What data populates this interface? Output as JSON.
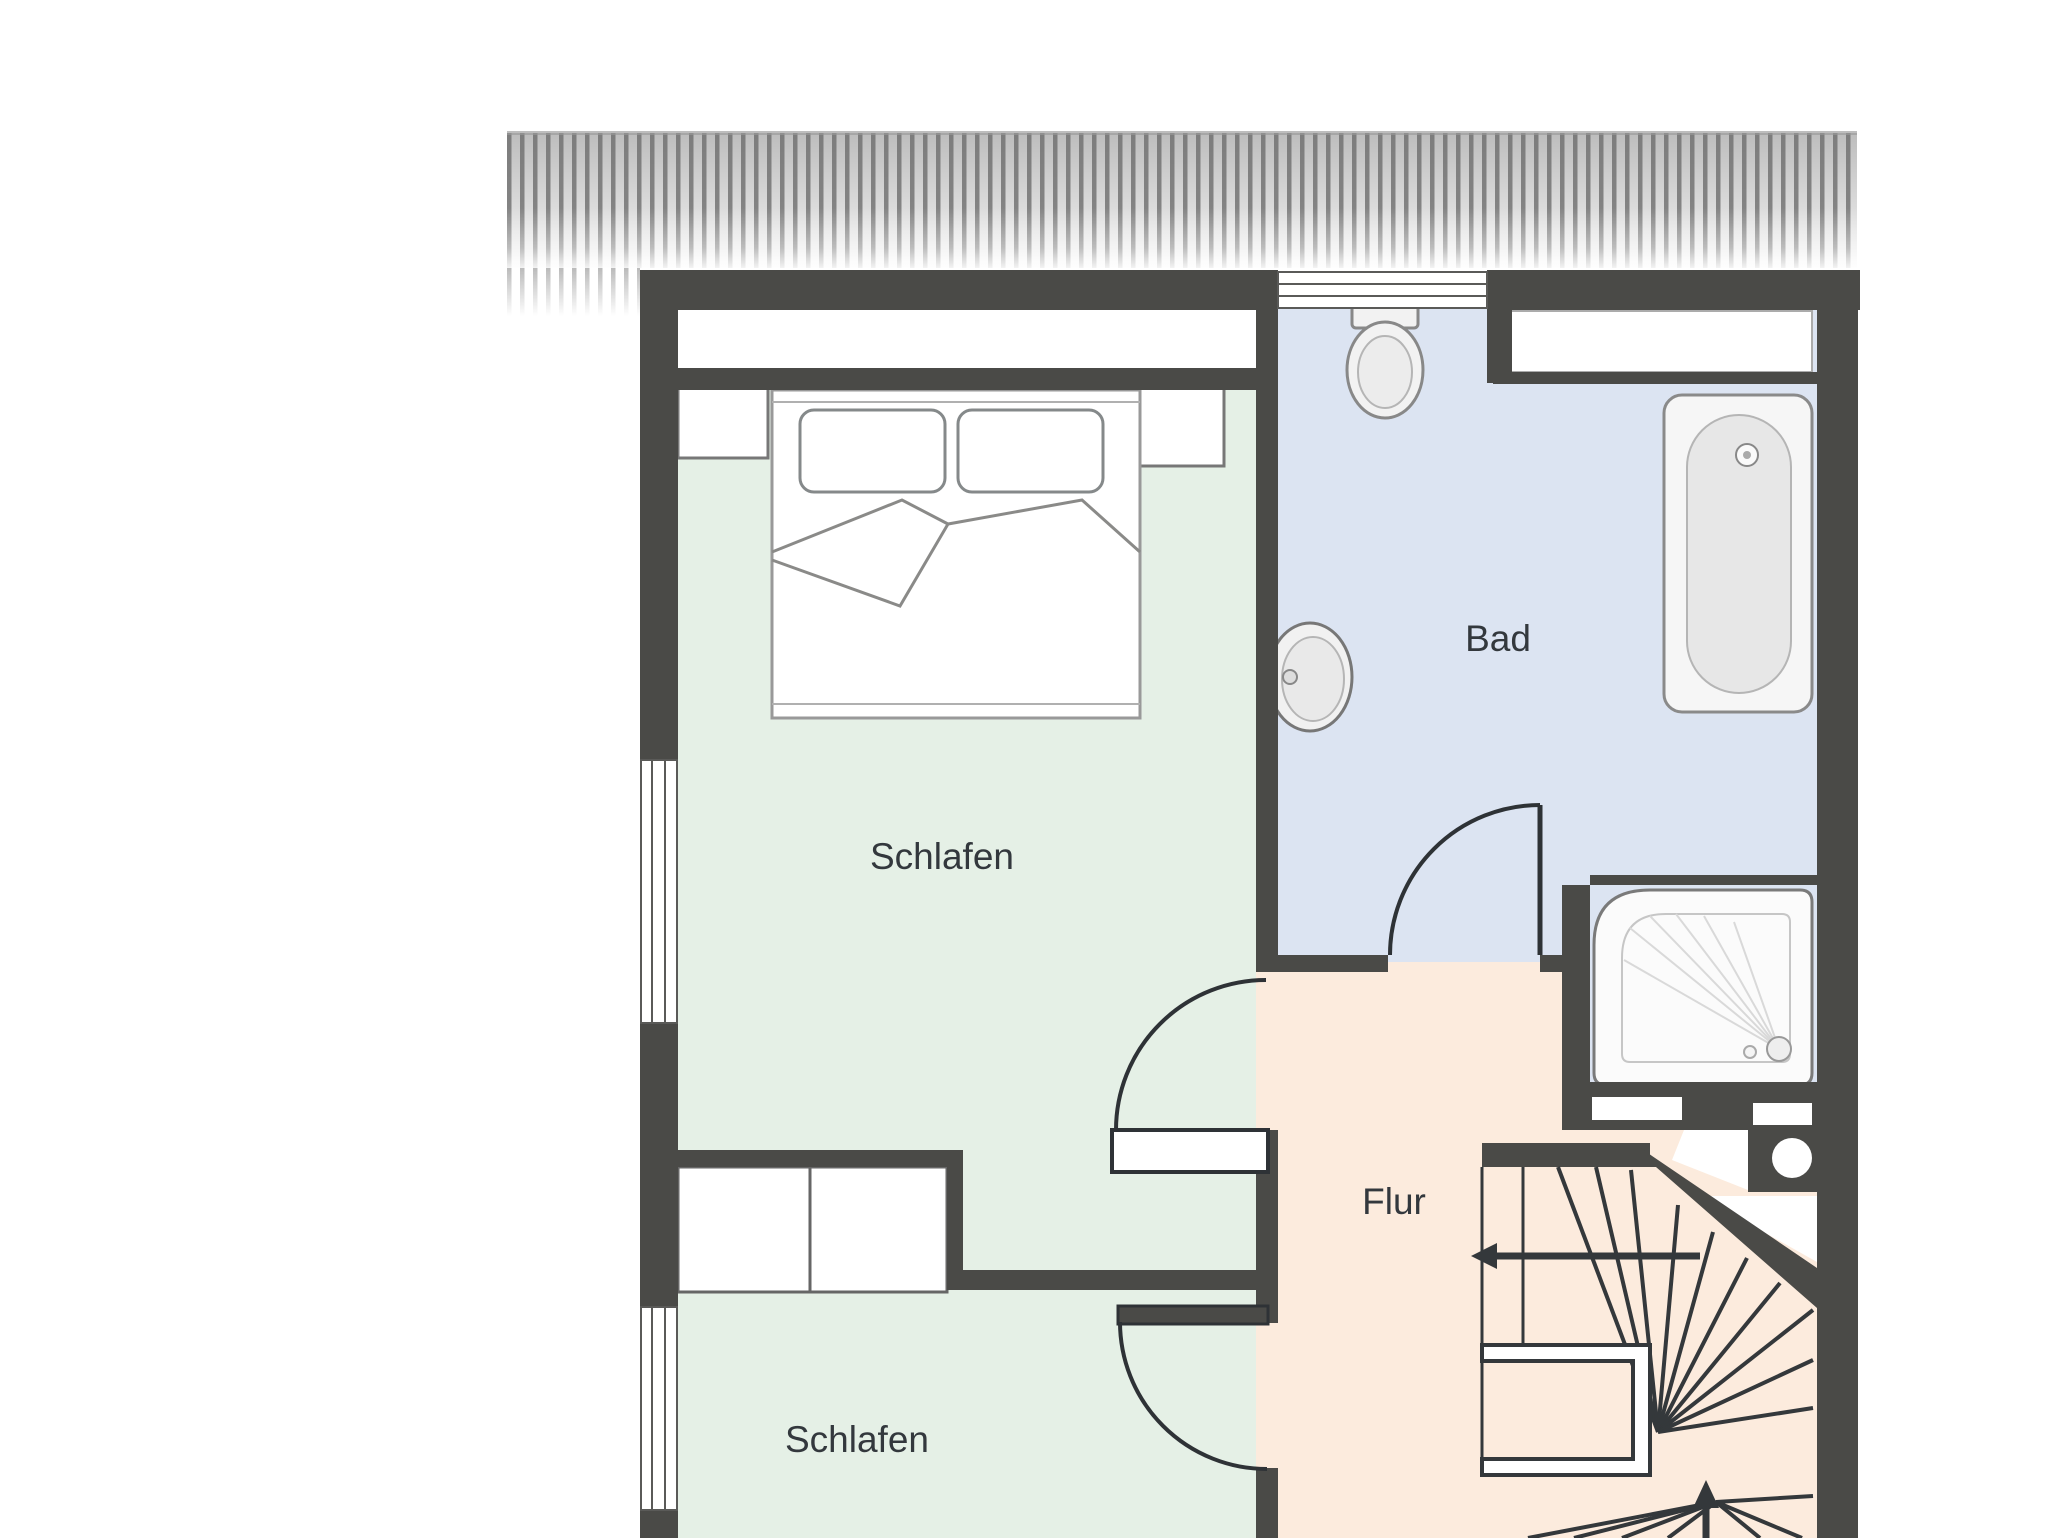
{
  "floorplan": {
    "labels": {
      "bedroom_top": "Schlafen",
      "bathroom": "Bad",
      "hallway": "Flur",
      "bedroom_bottom": "Schlafen"
    },
    "colors": {
      "wall": "#4a4a47",
      "bedroom_fill": "#e5f0e6",
      "bathroom_fill": "#dce4f2",
      "hallway_fill": "#fcebdd",
      "door_line": "#2e3236",
      "stair_line": "#34383b",
      "label_text": "#33383d",
      "fixture_outline": "#8a8a88",
      "hatch_stripe": "#6d6d6d",
      "canvas": "#ffffff"
    },
    "fixtures": {
      "bed": "double-bed",
      "nightstands": 2,
      "wardrobe_sections": 2,
      "toilet": "wc",
      "washbasin": "sink",
      "bathtub": "bathtub",
      "shower": "shower-tray",
      "staircase": "winder-staircase",
      "windows": 3,
      "doors": 3
    }
  }
}
